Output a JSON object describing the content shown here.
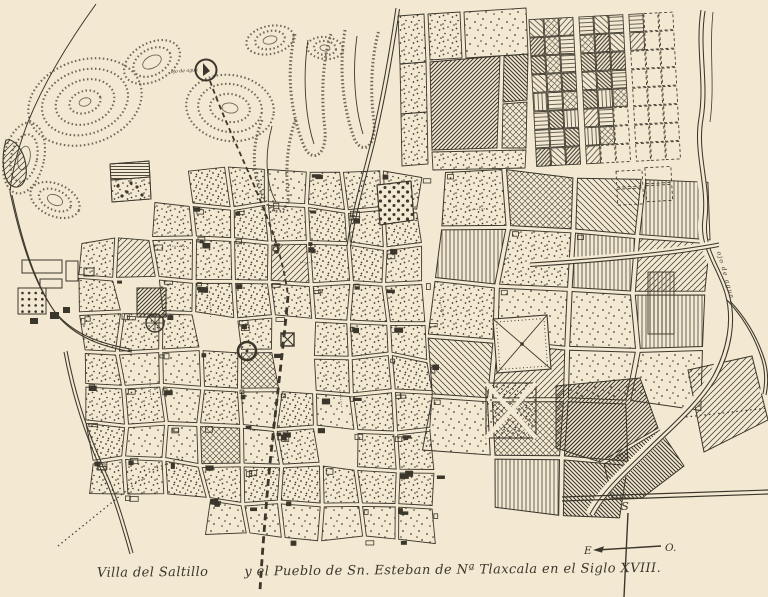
{
  "figure": {
    "caption_full": "Villa del Saltillo y el Pueblo de Sn. Esteban de Nª Tlaxcala en el Siglo XVIII.",
    "caption_part1": "Villa del Saltillo",
    "caption_part2": "y el Pueblo de Sn. Esteban de Nª Tlaxcala en el Siglo XVIII."
  },
  "compass": {
    "south": "S",
    "east": "E",
    "west": "O."
  },
  "map_labels": {
    "spring": "ojo de agua",
    "stream": "ojo de agua"
  },
  "colors": {
    "paper": "#f3e9d2",
    "ink": "#3b372c",
    "ink_light": "#6e675a"
  }
}
